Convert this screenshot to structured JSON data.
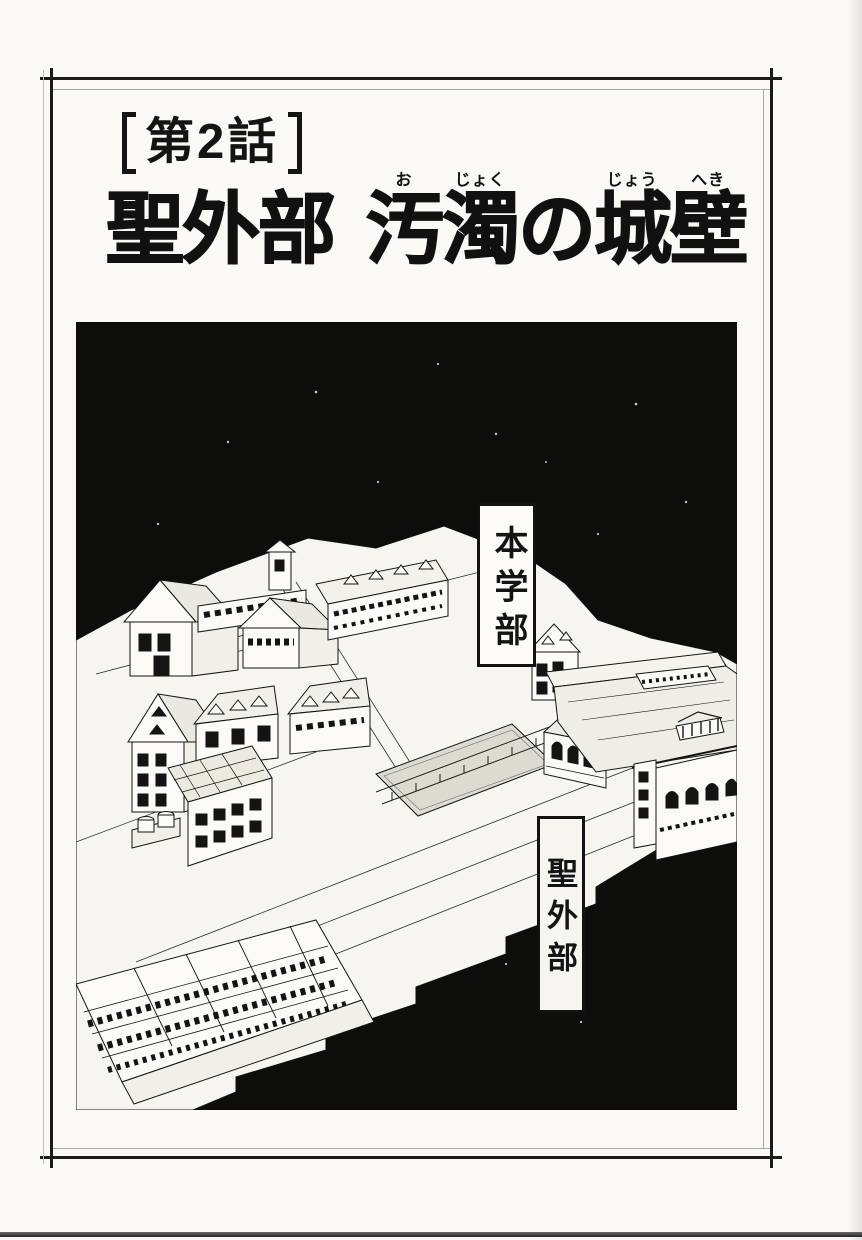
{
  "header": {
    "chapter_label": "第2話"
  },
  "title": {
    "plain": "聖外部 汚濁の城壁",
    "segments": [
      {
        "base": "聖"
      },
      {
        "base": "外"
      },
      {
        "base": "部"
      },
      {
        "base": " "
      },
      {
        "base": "汚",
        "ruby": "お"
      },
      {
        "base": "濁",
        "ruby": "じょく"
      },
      {
        "base": "の"
      },
      {
        "base": "城",
        "ruby": "じょう"
      },
      {
        "base": "壁",
        "ruby": "へき"
      }
    ]
  },
  "illustration": {
    "labels": [
      {
        "text": "本学部"
      },
      {
        "text": "聖外部"
      }
    ],
    "colors": {
      "paper": "#faf9f6",
      "line_ink": "#161616",
      "panel_background": "#0d0d0c"
    }
  }
}
